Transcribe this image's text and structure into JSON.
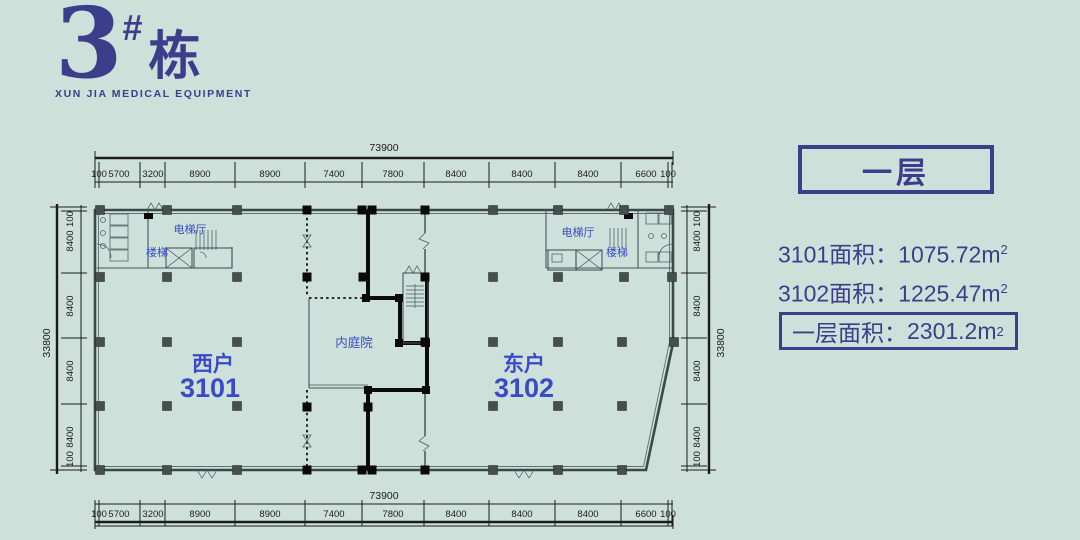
{
  "logo": {
    "number": "3",
    "hash": "#",
    "suffix": "栋",
    "subtitle": "XUN JIA MEDICAL EQUIPMENT"
  },
  "plan_labels": {
    "left_elevator_hall": "电梯厅",
    "left_stairs": "楼梯",
    "right_elevator_hall": "电梯厅",
    "right_stairs": "楼梯",
    "courtyard": "内庭院",
    "west_unit": {
      "name": "西户",
      "number": "3101"
    },
    "east_unit": {
      "name": "东户",
      "number": "3102"
    }
  },
  "dimensions": {
    "top": {
      "total": "73900",
      "segments": [
        "100",
        "5700",
        "3200",
        "8900",
        "8900",
        "7400",
        "7800",
        "8400",
        "8400",
        "8400",
        "6600",
        "100"
      ]
    },
    "bottom": {
      "total": "73900",
      "segments": [
        "100",
        "5700",
        "3200",
        "8900",
        "8900",
        "7400",
        "7800",
        "8400",
        "8400",
        "8400",
        "6600",
        "100"
      ]
    },
    "left": {
      "total": "33800",
      "segments": [
        "100",
        "8400",
        "8400",
        "8400",
        "8400",
        "100"
      ]
    },
    "right": {
      "total": "33800",
      "segments": [
        "100",
        "8400",
        "8400",
        "8400",
        "8400",
        "100"
      ]
    }
  },
  "info_panel": {
    "floor_label": "一层",
    "unit_areas": [
      {
        "label": "3101面积：",
        "value": "1075.72",
        "unit": "m",
        "exponent": "2"
      },
      {
        "label": "3102面积：",
        "value": "1225.47",
        "unit": "m",
        "exponent": "2"
      }
    ],
    "floor_area": {
      "label": "一层面积：",
      "value": "2301.2",
      "unit": "m",
      "exponent": "2"
    }
  },
  "colors": {
    "background": "#cde0da",
    "brand_indigo": "#3b3e8a",
    "label_blue": "#3a4ac6",
    "wall_dark": "#3a4a4c",
    "wall_black": "#0b0b0b"
  }
}
